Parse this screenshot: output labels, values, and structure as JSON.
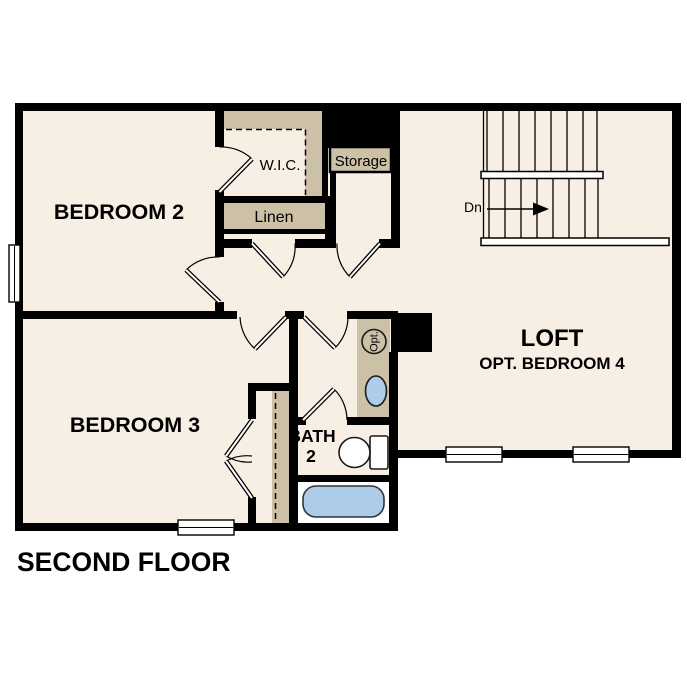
{
  "title": "SECOND FLOOR",
  "rooms": {
    "bedroom2": {
      "label": "BEDROOM 2"
    },
    "bedroom3": {
      "label": "BEDROOM 3"
    },
    "loft": {
      "label": "LOFT",
      "sublabel": "OPT. BEDROOM 4"
    },
    "bath": {
      "label_line1": "BATH",
      "label_line2": "2"
    },
    "wic": {
      "label": "W.I.C."
    },
    "linen": {
      "label": "Linen"
    },
    "storage": {
      "label": "Storage"
    }
  },
  "stairs": {
    "down_label": "Dn"
  },
  "annotations": {
    "optional_fixture": "Opt."
  },
  "colors": {
    "background": "#ffffff",
    "floor": "#f7efe4",
    "wall": "#000000",
    "shelf": "#ccc1a6",
    "fixture_blue": "#adcce9",
    "fixture_white": "#ffffff"
  }
}
